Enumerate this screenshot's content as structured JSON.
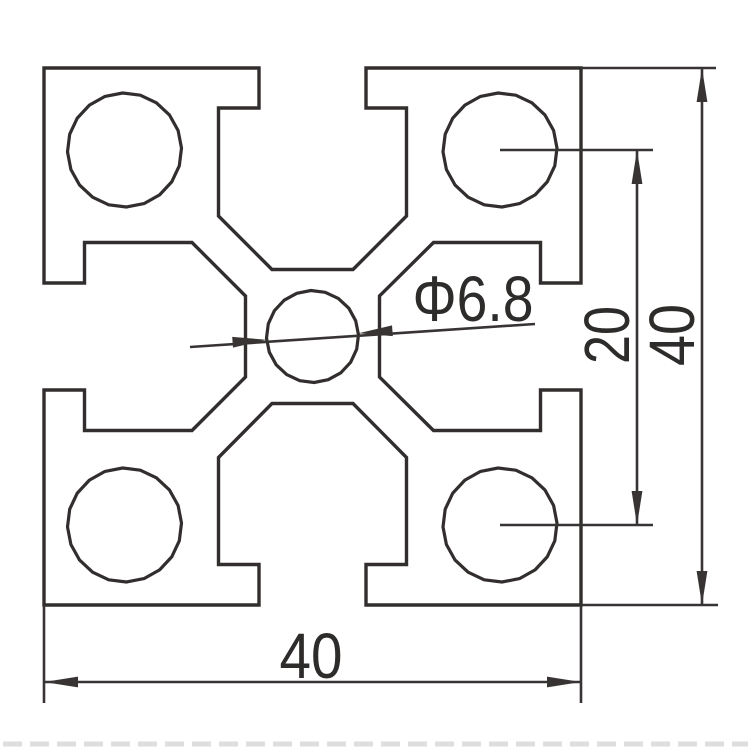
{
  "drawing": {
    "description": "Technical cross-section drawing of a 40x40 T-slot aluminum extrusion profile",
    "units": "mm",
    "dimensions": {
      "overall_width": 40,
      "overall_height": 40,
      "corner_hole_spacing": 20,
      "center_hole_diameter": 6.8
    },
    "style": {
      "background": "#ffffff",
      "profile_color": "#322e2e",
      "dim_color": "#383434",
      "profile_stroke_width": 3.4,
      "dim_stroke_width": 2.6,
      "circle_segments": 20,
      "arrow_length": 34,
      "arrow_half_width": 5.4
    },
    "profile": {
      "outline_path": "M 44,68 L 259,68 L 259,108 L 218.5,108 L 218.5,216 L 272,269.5 L 353,269.5 L 406.5,216 L 406.5,108 L 366,108 L 366,68 L 581,68 L 581,283 L 540.5,283 L 540.5,242.5 L 433.5,242.5 L 379.5,296 L 379.5,377 L 433.5,430.5 L 540.5,430.5 L 540.5,390 L 581,390 L 581,605 L 366,605 L 366,564.5 L 406.5,564.5 L 406.5,457.5 L 353,403.5 L 272,403.5 L 218.5,457.5 L 218.5,564.5 L 259,564.5 L 259,605 L 44,605 L 44,390 L 84.5,390 L 84.5,430.5 L 192,430.5 L 245.5,377 L 245.5,296 L 192,242.5 L 84.5,242.5 L 84.5,283 L 44,283 Z"
    },
    "holes": {
      "corner": [
        {
          "id": "corner-hole-top-left",
          "cx": 124.5,
          "cy": 150,
          "r": 57
        },
        {
          "id": "corner-hole-top-right",
          "cx": 500,
          "cy": 150,
          "r": 57
        },
        {
          "id": "corner-hole-bottom-left",
          "cx": 124.5,
          "cy": 525,
          "r": 57
        },
        {
          "id": "corner-hole-bottom-right",
          "cx": 500,
          "cy": 525,
          "r": 57
        }
      ],
      "center": {
        "id": "center-hole",
        "cx": 312.5,
        "cy": 336.5,
        "r": 46
      }
    },
    "extension_lines": [
      {
        "id": "ext-line-bottom-left",
        "x1": 44,
        "y1": 605,
        "x2": 44,
        "y2": 703
      },
      {
        "id": "ext-line-bottom-right",
        "x1": 581,
        "y1": 605,
        "x2": 581,
        "y2": 703
      },
      {
        "id": "ext-line-right-top",
        "x1": 581,
        "y1": 68,
        "x2": 716,
        "y2": 68
      },
      {
        "id": "ext-line-right-bottom",
        "x1": 581,
        "y1": 605,
        "x2": 718,
        "y2": 605
      },
      {
        "id": "ext-line-hole-center-top",
        "x1": 500,
        "y1": 150,
        "x2": 653,
        "y2": 150
      },
      {
        "id": "ext-line-hole-center-bottom",
        "x1": 500,
        "y1": 525,
        "x2": 653,
        "y2": 525
      }
    ],
    "dimension_lines": [
      {
        "id": "dim-line-bottom-width",
        "x1": 44,
        "y1": 682,
        "x2": 581,
        "y2": 682,
        "arrows": [
          {
            "x": 44,
            "y": 682,
            "a": 180
          },
          {
            "x": 581,
            "y": 682,
            "a": 0
          }
        ]
      },
      {
        "id": "dim-line-right-height",
        "x1": 702,
        "y1": 68,
        "x2": 702,
        "y2": 605,
        "arrows": [
          {
            "x": 702,
            "y": 68,
            "a": -90
          },
          {
            "x": 702,
            "y": 605,
            "a": 90
          }
        ]
      },
      {
        "id": "dim-line-hole-spacing",
        "x1": 637,
        "y1": 150,
        "x2": 637,
        "y2": 525,
        "arrows": [
          {
            "x": 637,
            "y": 150,
            "a": -90
          },
          {
            "x": 637,
            "y": 525,
            "a": 90
          }
        ]
      },
      {
        "id": "dim-line-center-hole-leader",
        "x1": 190,
        "y1": 347,
        "x2": 535,
        "y2": 324,
        "arrows": [
          {
            "x": 266.5,
            "y": 339.8,
            "a": -4.1
          },
          {
            "x": 358.5,
            "y": 333.2,
            "a": 175.9
          }
        ]
      }
    ],
    "labels": {
      "bottom_width": {
        "id": "dim-bottom-width-label",
        "text": "40",
        "x": 311,
        "y": 678,
        "size": 64,
        "text_length": 63
      },
      "right_height": {
        "id": "dim-right-height-label",
        "text": "40",
        "x": 694,
        "y": 335,
        "size": 64,
        "text_length": 62,
        "rotate": -90
      },
      "hole_spacing": {
        "id": "dim-hole-spacing-label",
        "text": "20",
        "x": 629,
        "y": 335,
        "size": 64,
        "text_length": 58,
        "rotate": -90
      },
      "center_hole": {
        "id": "dim-center-hole-label",
        "text": "Φ6.8",
        "x": 473,
        "y": 321,
        "size": 64,
        "text_length": 121
      }
    },
    "artifact": {
      "y": 744,
      "x1": 3,
      "x2": 748,
      "color": "#d9d9dc",
      "width": 5,
      "dash": "19 8"
    }
  }
}
